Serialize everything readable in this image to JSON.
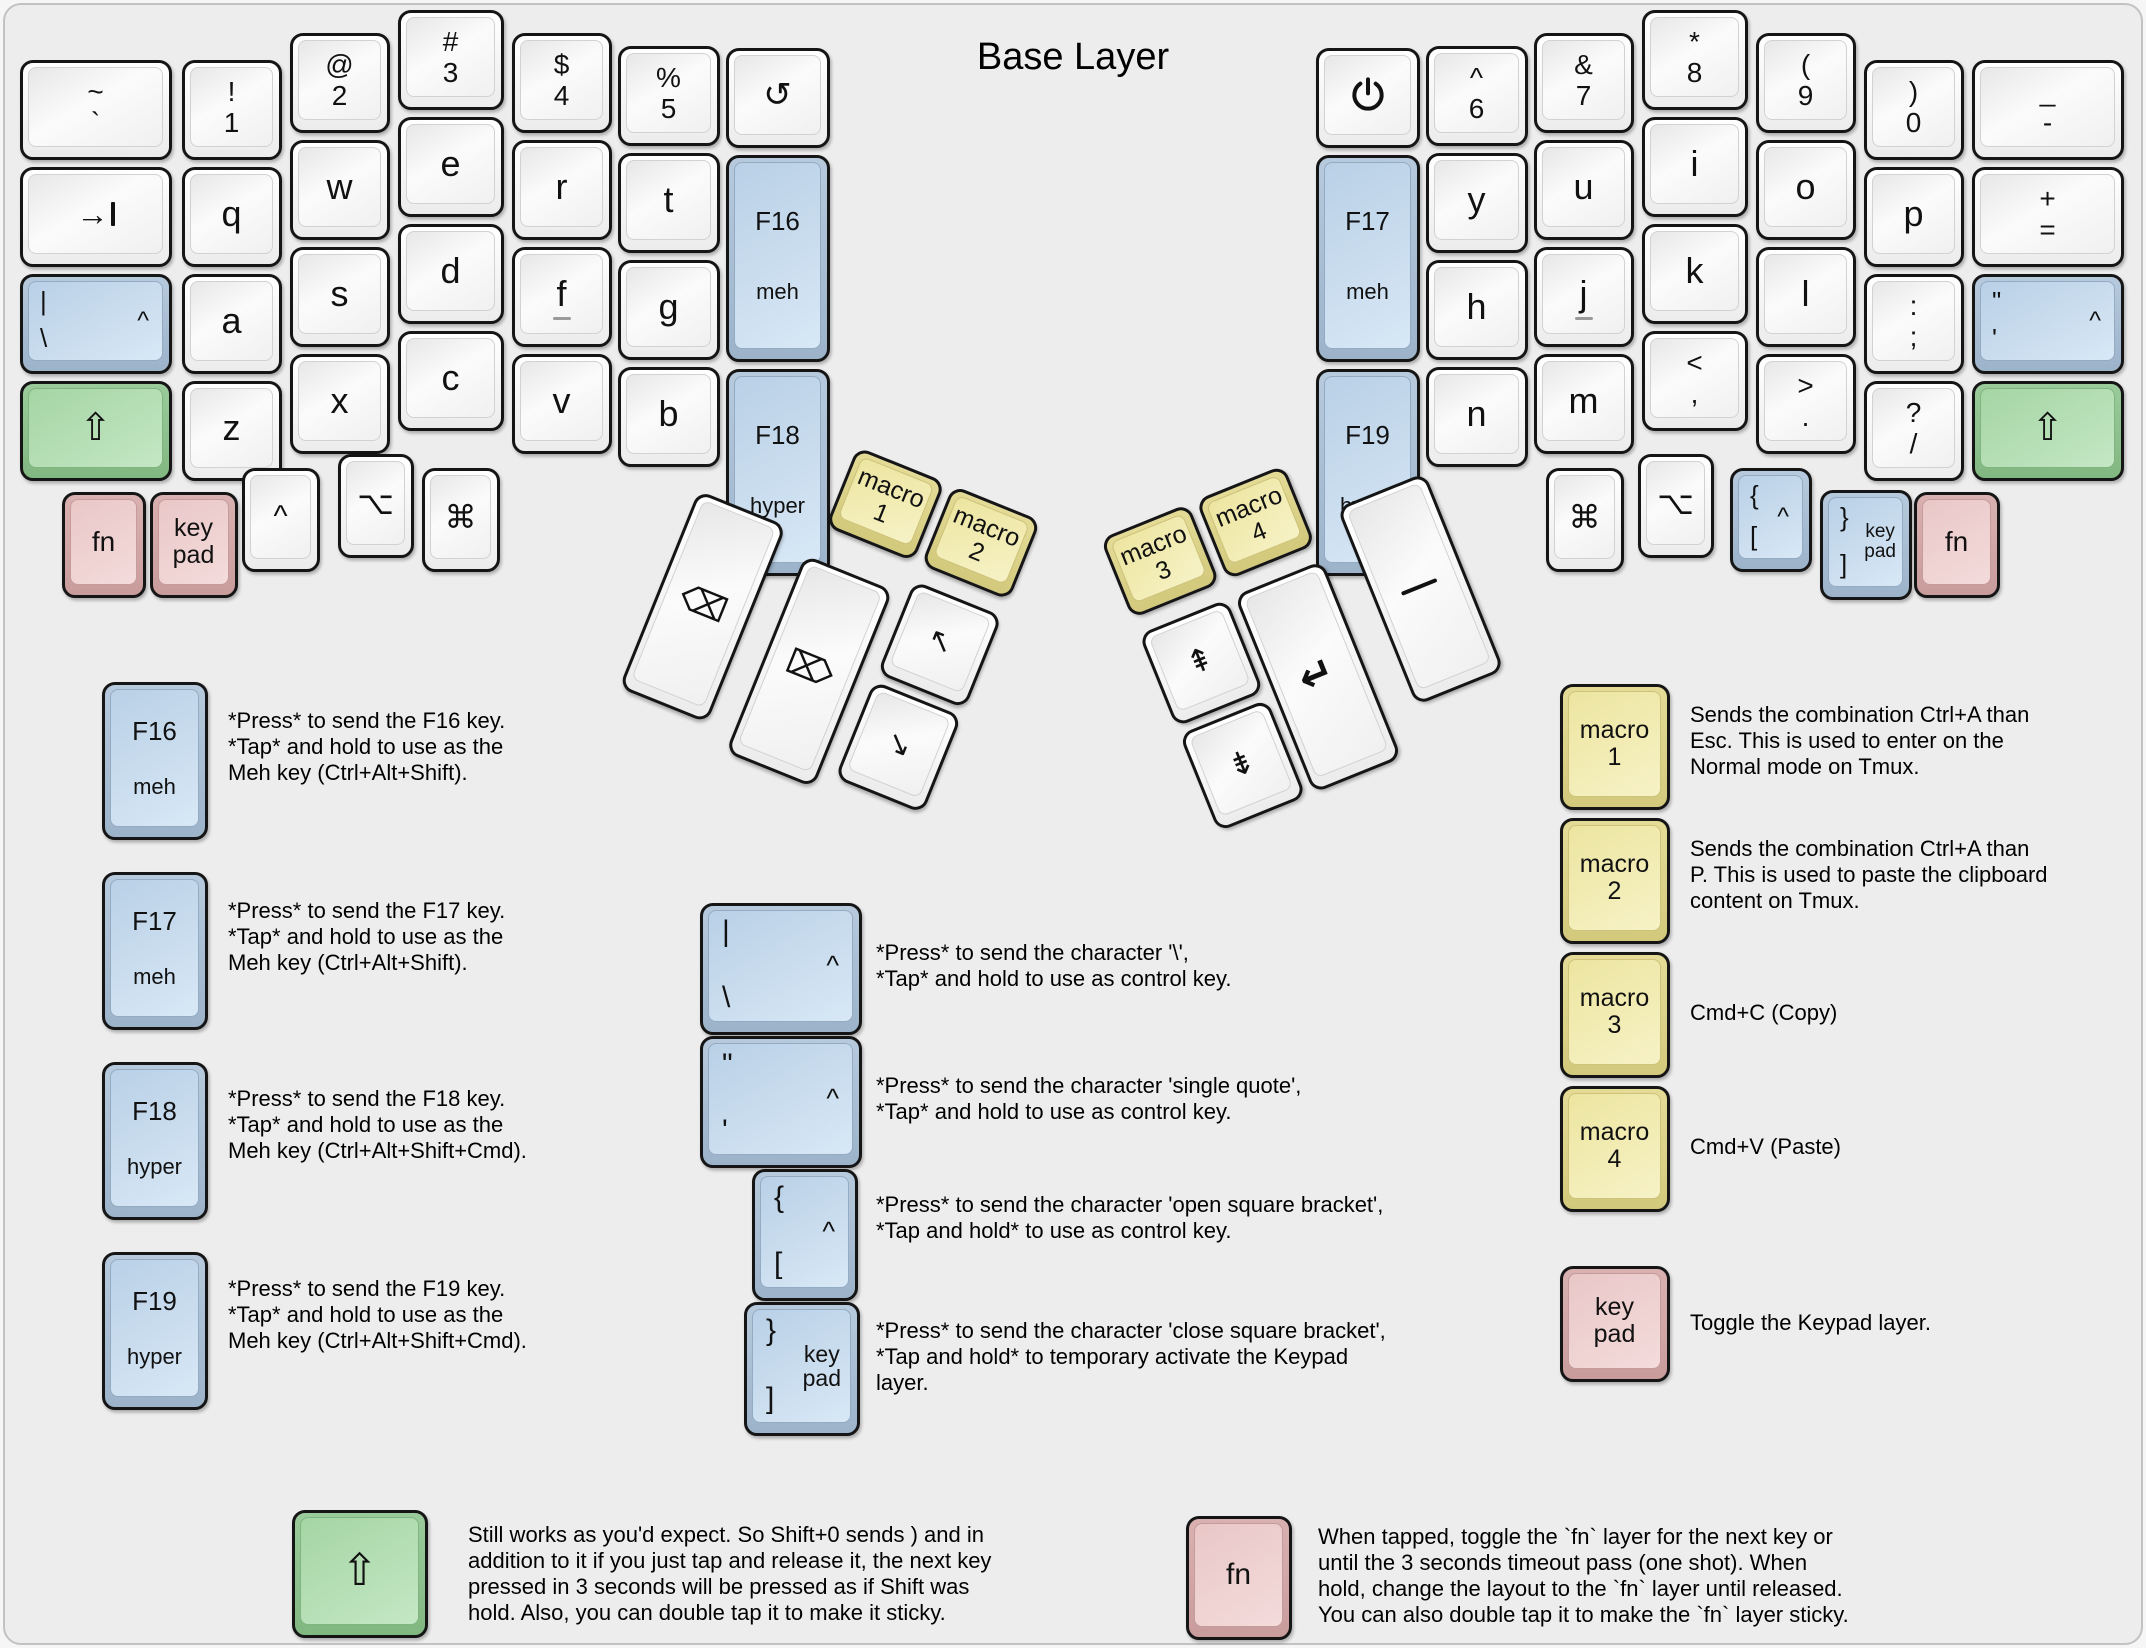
{
  "title": "Base Layer",
  "colors": {
    "background": "#ededed",
    "key_blue": "#bcd3e8",
    "key_green": "#a8d6a8",
    "key_pink": "#eac9c9",
    "key_yellow": "#eee9a7",
    "key_white": "#f4f4f4"
  },
  "board": {
    "left_main": [
      {
        "id": "l-tilde",
        "shift": "~",
        "main": "`",
        "name": "key-tilde"
      },
      {
        "id": "l-tab",
        "icon": "tab",
        "name": "key-tab"
      },
      {
        "id": "l-ctrl-bslash",
        "color": "blue",
        "top": "|",
        "bottom": "\\",
        "corner": "^",
        "name": "key-control-backslash"
      },
      {
        "id": "l-shift",
        "color": "green",
        "main": "⇧",
        "name": "key-left-shift"
      },
      {
        "id": "l-1",
        "shift": "!",
        "main": "1",
        "name": "key-1"
      },
      {
        "id": "l-q",
        "main": "q",
        "name": "key-q"
      },
      {
        "id": "l-a",
        "main": "a",
        "name": "key-a"
      },
      {
        "id": "l-z",
        "main": "z",
        "name": "key-z"
      },
      {
        "id": "l-2",
        "shift": "@",
        "main": "2",
        "name": "key-2"
      },
      {
        "id": "l-w",
        "main": "w",
        "name": "key-w"
      },
      {
        "id": "l-s",
        "main": "s",
        "name": "key-s"
      },
      {
        "id": "l-x",
        "main": "x",
        "name": "key-x"
      },
      {
        "id": "l-3",
        "shift": "#",
        "main": "3",
        "name": "key-3"
      },
      {
        "id": "l-e",
        "main": "e",
        "name": "key-e"
      },
      {
        "id": "l-d",
        "main": "d",
        "name": "key-d"
      },
      {
        "id": "l-c",
        "main": "c",
        "name": "key-c"
      },
      {
        "id": "l-4",
        "shift": "$",
        "main": "4",
        "name": "key-4"
      },
      {
        "id": "l-r",
        "main": "r",
        "name": "key-r"
      },
      {
        "id": "l-f",
        "main": "f",
        "homing": true,
        "name": "key-f"
      },
      {
        "id": "l-v",
        "main": "v",
        "name": "key-v"
      },
      {
        "id": "l-5",
        "shift": "%",
        "main": "5",
        "name": "key-5"
      },
      {
        "id": "l-t",
        "main": "t",
        "name": "key-t"
      },
      {
        "id": "l-g",
        "main": "g",
        "name": "key-g"
      },
      {
        "id": "l-b",
        "main": "b",
        "name": "key-b"
      },
      {
        "id": "l-undo",
        "main": "↺",
        "name": "key-undo"
      },
      {
        "id": "l-f16",
        "color": "blue",
        "fkey": "F16",
        "sub": "meh",
        "name": "key-f16-meh"
      },
      {
        "id": "l-f18",
        "color": "blue",
        "fkey": "F18",
        "sub": "hyper",
        "name": "key-f18-hyper"
      }
    ],
    "left_bottom": [
      {
        "id": "l-fn",
        "color": "pink",
        "main": "fn",
        "name": "key-fn-left"
      },
      {
        "id": "l-keypad",
        "color": "pink",
        "lines": [
          "key",
          "pad"
        ],
        "name": "key-keypad-left"
      },
      {
        "id": "l-ctrl",
        "main": "^",
        "name": "key-control-left"
      },
      {
        "id": "l-opt",
        "main": "⌥",
        "name": "key-option-left"
      },
      {
        "id": "l-cmd",
        "main": "⌘",
        "name": "key-command-left"
      }
    ],
    "left_thumb": [
      {
        "id": "t-macro1",
        "color": "yellow",
        "lines": [
          "macro",
          "1"
        ],
        "name": "key-macro-1"
      },
      {
        "id": "t-macro2",
        "color": "yellow",
        "lines": [
          "macro",
          "2"
        ],
        "name": "key-macro-2"
      },
      {
        "id": "t-bksp",
        "main": "⌫",
        "name": "key-backspace"
      },
      {
        "id": "t-del",
        "main": "⌦",
        "name": "key-delete"
      },
      {
        "id": "t-home",
        "main": "↖",
        "name": "key-home"
      },
      {
        "id": "t-end",
        "main": "↘",
        "name": "key-end"
      }
    ],
    "right_thumb": [
      {
        "id": "t-macro3",
        "color": "yellow",
        "lines": [
          "macro",
          "3"
        ],
        "name": "key-macro-3"
      },
      {
        "id": "t-macro4",
        "color": "yellow",
        "lines": [
          "macro",
          "4"
        ],
        "name": "key-macro-4"
      },
      {
        "id": "t-pgup",
        "main": "⇞",
        "name": "key-page-up"
      },
      {
        "id": "t-pgdn",
        "main": "⇟",
        "name": "key-page-down"
      },
      {
        "id": "t-enter",
        "main": "↵",
        "name": "key-enter"
      },
      {
        "id": "t-space",
        "icon": "space",
        "name": "key-space"
      }
    ],
    "right_main": [
      {
        "id": "r-power",
        "icon": "power",
        "name": "key-power"
      },
      {
        "id": "r-f17",
        "color": "blue",
        "fkey": "F17",
        "sub": "meh",
        "name": "key-f17-meh"
      },
      {
        "id": "r-f19",
        "color": "blue",
        "fkey": "F19",
        "sub": "hyper",
        "name": "key-f19-hyper"
      },
      {
        "id": "r-6",
        "shift": "^",
        "main": "6",
        "name": "key-6"
      },
      {
        "id": "r-y",
        "main": "y",
        "name": "key-y"
      },
      {
        "id": "r-h",
        "main": "h",
        "name": "key-h"
      },
      {
        "id": "r-n",
        "main": "n",
        "name": "key-n"
      },
      {
        "id": "r-7",
        "shift": "&",
        "main": "7",
        "name": "key-7"
      },
      {
        "id": "r-u",
        "main": "u",
        "name": "key-u"
      },
      {
        "id": "r-j",
        "main": "j",
        "homing": true,
        "name": "key-j"
      },
      {
        "id": "r-m",
        "main": "m",
        "name": "key-m"
      },
      {
        "id": "r-8",
        "shift": "*",
        "main": "8",
        "name": "key-8"
      },
      {
        "id": "r-i",
        "main": "i",
        "name": "key-i"
      },
      {
        "id": "r-k",
        "main": "k",
        "name": "key-k"
      },
      {
        "id": "r-comma",
        "shift": "<",
        "main": ",",
        "name": "key-comma"
      },
      {
        "id": "r-9",
        "shift": "(",
        "main": "9",
        "name": "key-9"
      },
      {
        "id": "r-o",
        "main": "o",
        "name": "key-o"
      },
      {
        "id": "r-l",
        "main": "l",
        "name": "key-l"
      },
      {
        "id": "r-period",
        "shift": ">",
        "main": ".",
        "name": "key-period"
      },
      {
        "id": "r-0",
        "shift": ")",
        "main": "0",
        "name": "key-0"
      },
      {
        "id": "r-p",
        "main": "p",
        "name": "key-p"
      },
      {
        "id": "r-semi",
        "shift": ":",
        "main": ";",
        "name": "key-semicolon"
      },
      {
        "id": "r-slash",
        "shift": "?",
        "main": "/",
        "name": "key-slash"
      },
      {
        "id": "r-dash",
        "shift": "_",
        "main": "-",
        "name": "key-dash"
      },
      {
        "id": "r-equal",
        "shift": "+",
        "main": "=",
        "name": "key-equal"
      },
      {
        "id": "r-ctrl-quote",
        "color": "blue",
        "top": "\"",
        "bottom": "'",
        "corner": "^",
        "name": "key-control-quote"
      },
      {
        "id": "r-shift",
        "color": "green",
        "main": "⇧",
        "name": "key-right-shift"
      }
    ],
    "right_bottom": [
      {
        "id": "r-cmd",
        "main": "⌘",
        "name": "key-command-right"
      },
      {
        "id": "r-opt",
        "main": "⌥",
        "name": "key-option-right"
      },
      {
        "id": "r-obracket",
        "color": "blue",
        "top": "{",
        "bottom": "[",
        "corner": "^",
        "name": "key-control-open-bracket"
      },
      {
        "id": "r-keypad",
        "color": "blue",
        "top": "}",
        "bottom": "]",
        "right_lines": [
          "key",
          "pad"
        ],
        "name": "key-keypad-close-bracket"
      },
      {
        "id": "r-fn",
        "color": "pink",
        "main": "fn",
        "name": "key-fn-right"
      }
    ]
  },
  "legends": [
    {
      "id": "f16",
      "key": {
        "id": "leg-f16",
        "color": "blue",
        "fkey": "F16",
        "sub": "meh"
      },
      "text": "*Press* to send the F16 key.\n*Tap* and hold to use as the\nMeh key (Ctrl+Alt+Shift)."
    },
    {
      "id": "f17",
      "key": {
        "id": "leg-f17",
        "color": "blue",
        "fkey": "F17",
        "sub": "meh"
      },
      "text": "*Press* to send the F17 key.\n*Tap* and hold to use as the\nMeh key (Ctrl+Alt+Shift)."
    },
    {
      "id": "f18",
      "key": {
        "id": "leg-f18",
        "color": "blue",
        "fkey": "F18",
        "sub": "hyper"
      },
      "text": "*Press* to send the F18 key.\n*Tap* and hold to use as the\nMeh key (Ctrl+Alt+Shift+Cmd)."
    },
    {
      "id": "f19",
      "key": {
        "id": "leg-f19",
        "color": "blue",
        "fkey": "F19",
        "sub": "hyper"
      },
      "text": "*Press* to send the F19 key.\n*Tap* and hold to use as the\nMeh key (Ctrl+Alt+Shift+Cmd)."
    },
    {
      "id": "pipe",
      "key": {
        "id": "leg-pipe",
        "color": "blue",
        "top": "|",
        "bottom": "\\",
        "corner": "^"
      },
      "text": "*Press* to send the character '\\',\n*Tap* and hold to use as control key."
    },
    {
      "id": "quote",
      "key": {
        "id": "leg-quote",
        "color": "blue",
        "top": "\"",
        "bottom": "'",
        "corner": "^"
      },
      "text": "*Press* to send the character 'single quote',\n*Tap* and hold to use as control key."
    },
    {
      "id": "open-bracket",
      "key": {
        "id": "leg-obracket",
        "color": "blue",
        "top": "{",
        "bottom": "[",
        "corner": "^"
      },
      "text": "*Press* to send the character 'open square bracket',\n*Tap and hold* to use as control key."
    },
    {
      "id": "close-bracket",
      "key": {
        "id": "leg-cbracket",
        "color": "blue",
        "top": "}",
        "bottom": "]",
        "right_lines": [
          "key",
          "pad"
        ]
      },
      "text": "*Press* to send the character 'close square bracket',\n*Tap and hold* to temporary activate the Keypad\nlayer."
    },
    {
      "id": "macro1",
      "key": {
        "id": "leg-macro1",
        "color": "yellow",
        "lines": [
          "macro",
          "1"
        ]
      },
      "text": "Sends the combination Ctrl+A than\nEsc. This is used to enter on the\nNormal mode on Tmux."
    },
    {
      "id": "macro2",
      "key": {
        "id": "leg-macro2",
        "color": "yellow",
        "lines": [
          "macro",
          "2"
        ]
      },
      "text": "Sends the combination Ctrl+A than\nP. This is used to paste the clipboard\ncontent on Tmux."
    },
    {
      "id": "macro3",
      "key": {
        "id": "leg-macro3",
        "color": "yellow",
        "lines": [
          "macro",
          "3"
        ]
      },
      "text": "Cmd+C (Copy)"
    },
    {
      "id": "macro4",
      "key": {
        "id": "leg-macro4",
        "color": "yellow",
        "lines": [
          "macro",
          "4"
        ]
      },
      "text": "Cmd+V (Paste)"
    },
    {
      "id": "keypad",
      "key": {
        "id": "leg-keypad",
        "color": "pink",
        "lines": [
          "key",
          "pad"
        ]
      },
      "text": "Toggle the Keypad layer."
    },
    {
      "id": "shift",
      "key": {
        "id": "leg-shift",
        "color": "green",
        "main": "⇧"
      },
      "text": "Still works as you'd expect. So Shift+0 sends ) and in\naddition to it if you just tap and release it, the next key\npressed in 3 seconds will be pressed as if Shift was\nhold. Also, you can double tap it to make it sticky."
    },
    {
      "id": "fn",
      "key": {
        "id": "leg-fn",
        "color": "pink",
        "main": "fn"
      },
      "text": "When tapped, toggle the `fn` layer for the next key or\nuntil the 3 seconds timeout pass (one shot). When\nhold, change the layout to the `fn` layer until released.\nYou can also double tap it to make the `fn` layer sticky."
    }
  ]
}
